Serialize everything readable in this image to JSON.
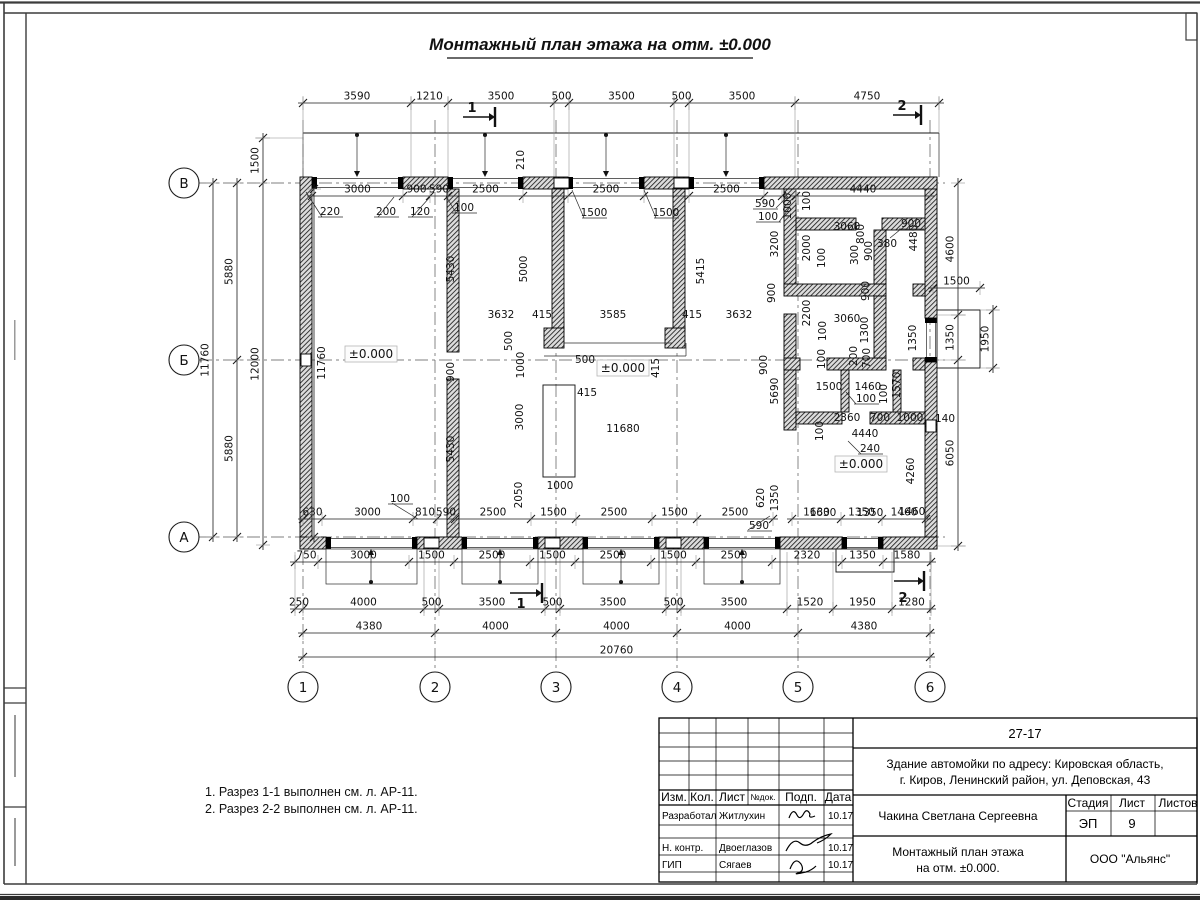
{
  "sheet": {
    "title": "Монтажный план этажа на отм. ±0.000",
    "notes": [
      "1. Разрез 1-1 выполнен см. л. АР-11.",
      "2. Разрез 2-2 выполнен см. л. АР-11."
    ]
  },
  "axes": {
    "rows": [
      "В",
      "Б",
      "А"
    ],
    "cols": [
      "1",
      "2",
      "3",
      "4",
      "5",
      "6"
    ]
  },
  "levels": {
    "zero": "±0.000"
  },
  "sections": {
    "s1": "1",
    "s2": "2"
  },
  "dims": {
    "top_outer": [
      "3590",
      "1210",
      "3500",
      "500",
      "3500",
      "500",
      "3500",
      "4750"
    ],
    "top_inner": [
      "3000",
      "900",
      "590",
      "2500",
      "",
      "2500",
      "",
      "2500",
      ""
    ],
    "right_top": [
      "4440"
    ],
    "bottom_inner": [
      "630",
      "3000",
      "810",
      "590",
      "2500",
      "1500",
      "2500",
      "1500",
      "2500"
    ],
    "bottom_inner2": [
      "1630",
      "1350",
      "1460"
    ],
    "bottom_mid": [
      "750",
      "3000",
      "1500",
      "2500",
      "1500",
      "2500",
      "1500",
      "2500",
      "2320",
      "1350",
      "1580"
    ],
    "bottom_outer": [
      "250",
      "4000",
      "500",
      "3500",
      "500",
      "3500",
      "500",
      "3500",
      "1520",
      "1950",
      "1280"
    ],
    "bottom_axes": [
      "4380",
      "4000",
      "4000",
      "4000",
      "4380"
    ],
    "bottom_total": [
      "20760"
    ],
    "porch_top": [
      "1500"
    ],
    "left_outer": [
      "11760"
    ],
    "left_mid": [
      "5880",
      "5880"
    ],
    "left_inner": [
      "1500",
      "12000"
    ],
    "left_wall": [
      "11760"
    ],
    "right_outer": [
      "4600",
      "1350",
      "6050"
    ],
    "right_porch": [
      "1950"
    ],
    "labels": [
      "220",
      "200",
      "120",
      "100",
      "1500",
      "1500",
      "590",
      "100",
      "210",
      "1000",
      "100",
      "5430",
      "5000",
      "5415",
      "3200",
      "2000",
      "3060",
      "800",
      "300",
      "900",
      "380",
      "900",
      "4480",
      "100",
      "900",
      "2200",
      "3060",
      "100",
      "1300",
      "900",
      "3632",
      "415",
      "3585",
      "415",
      "3632",
      "500",
      "500",
      "415",
      "1000",
      "415",
      "3000",
      "11680",
      "1000",
      "2050",
      "900",
      "5430",
      "5690",
      "900",
      "100",
      "200",
      "700",
      "1500",
      "1460",
      "100",
      "1570",
      "100",
      "2360",
      "700",
      "1000",
      "140",
      "100",
      "4440",
      "240",
      "4260",
      "1630",
      "1350",
      "1460",
      "620",
      "1350",
      "590",
      "100",
      "1350"
    ]
  },
  "titleblock": {
    "doc_number": "27-17",
    "object_line1": "Здание автомойки по адресу: Кировская область,",
    "object_line2": "г. Киров, Ленинский район, ул. Деповская, 43",
    "cols": {
      "izm": "Изм.",
      "kol": "Кол.",
      "list": "Лист",
      "ndok": "№док.",
      "podp": "Подп.",
      "data": "Дата"
    },
    "rows": [
      {
        "role": "Разработал",
        "name": "Житлухин",
        "date": "10.17"
      },
      {
        "role": "Н. контр.",
        "name": "Двоеглазов",
        "date": "10.17"
      },
      {
        "role": "ГИП",
        "name": "Сягаев",
        "date": "10.17"
      }
    ],
    "author": "Чакина Светлана Сергеевна",
    "stage_label": "Стадия",
    "sheet_label": "Лист",
    "sheets_label": "Листов",
    "stage": "ЭП",
    "sheet_number": "9",
    "drawing_line1": "Монтажный план этажа",
    "drawing_line2": "на отм. ±0.000.",
    "company": "ООО \"Альянс\""
  }
}
